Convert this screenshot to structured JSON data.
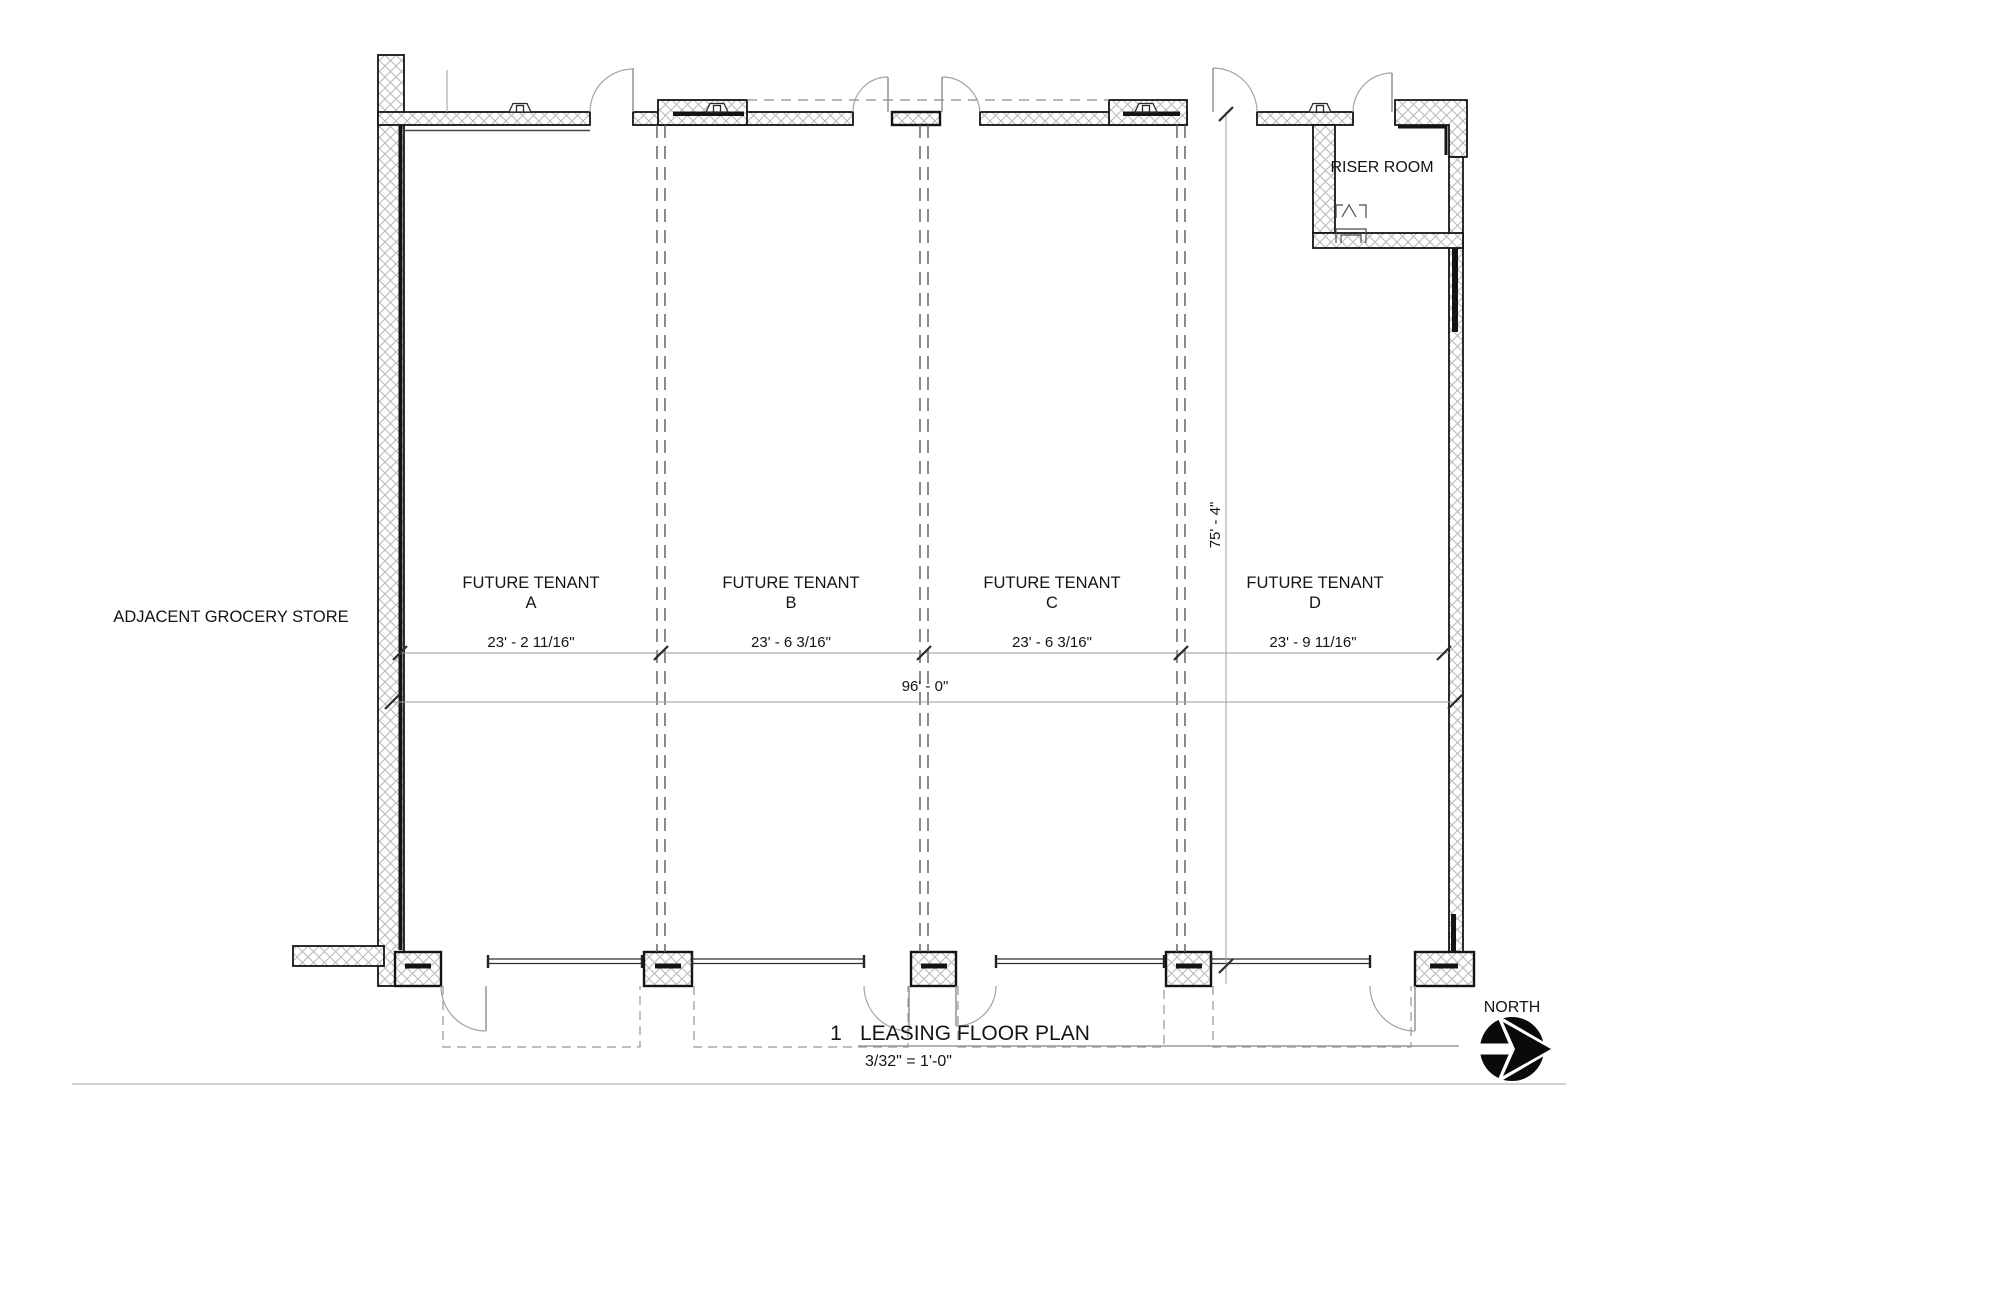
{
  "plan": {
    "adjacent_store_label": "ADJACENT GROCERY STORE",
    "riser_room_label": "RISER ROOM",
    "tenants": [
      {
        "label": "FUTURE TENANT",
        "letter": "A",
        "width": "23' - 2 11/16\""
      },
      {
        "label": "FUTURE TENANT",
        "letter": "B",
        "width": "23' - 6 3/16\""
      },
      {
        "label": "FUTURE TENANT",
        "letter": "C",
        "width": "23' - 6 3/16\""
      },
      {
        "label": "FUTURE TENANT",
        "letter": "D",
        "width": "23' - 9 11/16\""
      }
    ],
    "dimensions": {
      "overall_width": "96' - 0\"",
      "overall_depth": "75' - 4\""
    },
    "north_label": "NORTH"
  },
  "title_block": {
    "detail_number": "1",
    "title": "LEASING FLOOR PLAN",
    "scale": "3/32\" = 1'-0\""
  },
  "colors": {
    "wall_line": "#141414",
    "hatch": "#b8b8b8",
    "dimension_line": "#9e9e9e",
    "door_swing": "#a3a3a3",
    "text": "#141414",
    "background": "#ffffff"
  }
}
